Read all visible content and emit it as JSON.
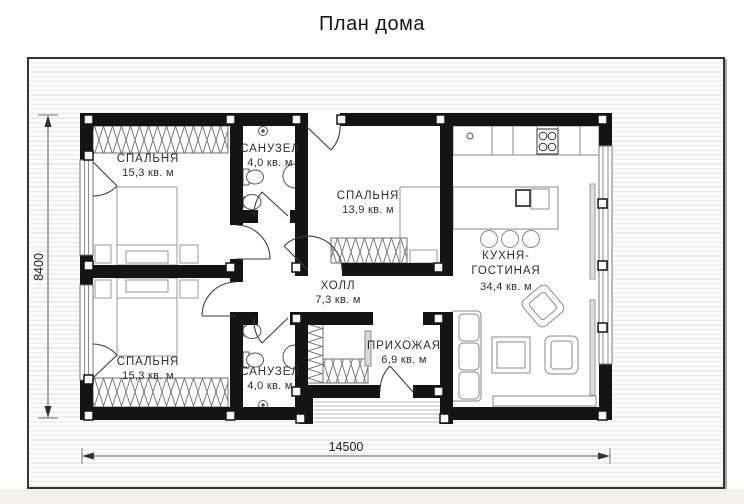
{
  "title": "План дома",
  "colors": {
    "wall": "#141414",
    "stripe_background": "#ececec",
    "furniture_line": "#909090",
    "door_line": "#3c3c3c",
    "label_text": "#2e2e2e"
  },
  "rooms": [
    {
      "id": "bedroom-top",
      "name": "СПАЛЬНЯ",
      "area": "15,3 кв. м"
    },
    {
      "id": "bathroom-top",
      "name": "САНУЗЕЛ",
      "area": "4,0 кв. м"
    },
    {
      "id": "bedroom-middle",
      "name": "СПАЛЬНЯ",
      "area": "13,9 кв. м"
    },
    {
      "id": "kitchen-living",
      "name1": "КУХНЯ-",
      "name2": "ГОСТИНАЯ",
      "area": "34,4 кв. м"
    },
    {
      "id": "hall",
      "name": "ХОЛЛ",
      "area": "7,3 кв. м"
    },
    {
      "id": "entry",
      "name": "ПРИХОЖАЯ",
      "area": "6,9 кв. м"
    },
    {
      "id": "bedroom-bottom",
      "name": "СПАЛЬНЯ",
      "area": "15,3 кв. м"
    },
    {
      "id": "bathroom-bottom",
      "name": "САНУЗЕЛ",
      "area": "4,0 кв. м"
    }
  ],
  "dimensions": {
    "width": "14500",
    "height": "8400"
  }
}
